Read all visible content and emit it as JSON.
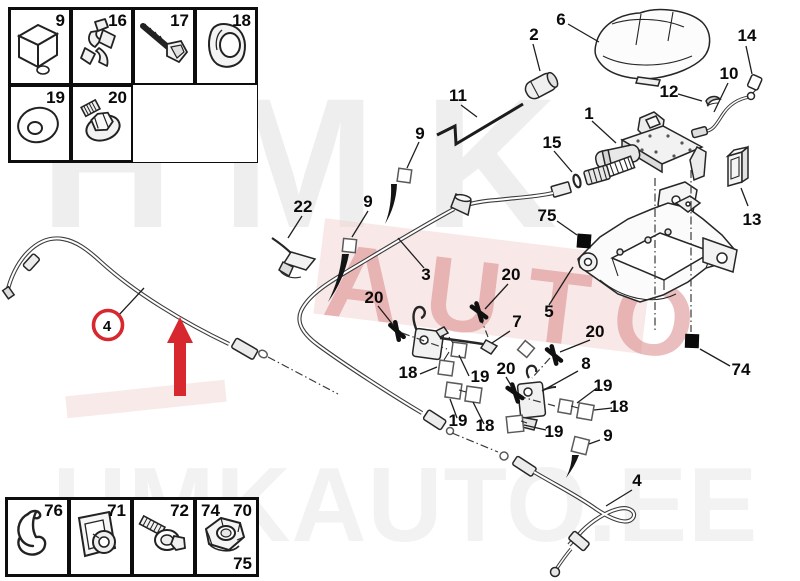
{
  "watermarks": {
    "top": "HMK",
    "middle": "AUTO",
    "bottom": "HMKAUTO.EE"
  },
  "top_box": {
    "cells": [
      "9",
      "16",
      "17",
      "18",
      "19",
      "20"
    ]
  },
  "bottom_box": {
    "cells": [
      "76",
      "71",
      "72"
    ],
    "last_cell": {
      "top_left": "74",
      "top_right": "70",
      "bottom_right": "75"
    }
  },
  "colors": {
    "highlight_red": "#d7282f",
    "line_art": "#262626",
    "watermark_pink": "#d67e7e"
  },
  "diagram": {
    "labels": [
      {
        "t": "6"
      },
      {
        "t": "2"
      },
      {
        "t": "14"
      },
      {
        "t": "10"
      },
      {
        "t": "12"
      },
      {
        "t": "11"
      },
      {
        "t": "1"
      },
      {
        "t": "15"
      },
      {
        "t": "9"
      },
      {
        "t": "13"
      },
      {
        "t": "22"
      },
      {
        "t": "9"
      },
      {
        "t": "75"
      },
      {
        "t": "3"
      },
      {
        "t": "5"
      },
      {
        "t": "20"
      },
      {
        "t": "20"
      },
      {
        "t": "7"
      },
      {
        "t": "20"
      },
      {
        "t": "8"
      },
      {
        "t": "18"
      },
      {
        "t": "19"
      },
      {
        "t": "19"
      },
      {
        "t": "18"
      },
      {
        "t": "20"
      },
      {
        "t": "19"
      },
      {
        "t": "18"
      },
      {
        "t": "19"
      },
      {
        "t": "9"
      },
      {
        "t": "74"
      },
      {
        "t": "4"
      },
      {
        "t": "4"
      }
    ]
  }
}
